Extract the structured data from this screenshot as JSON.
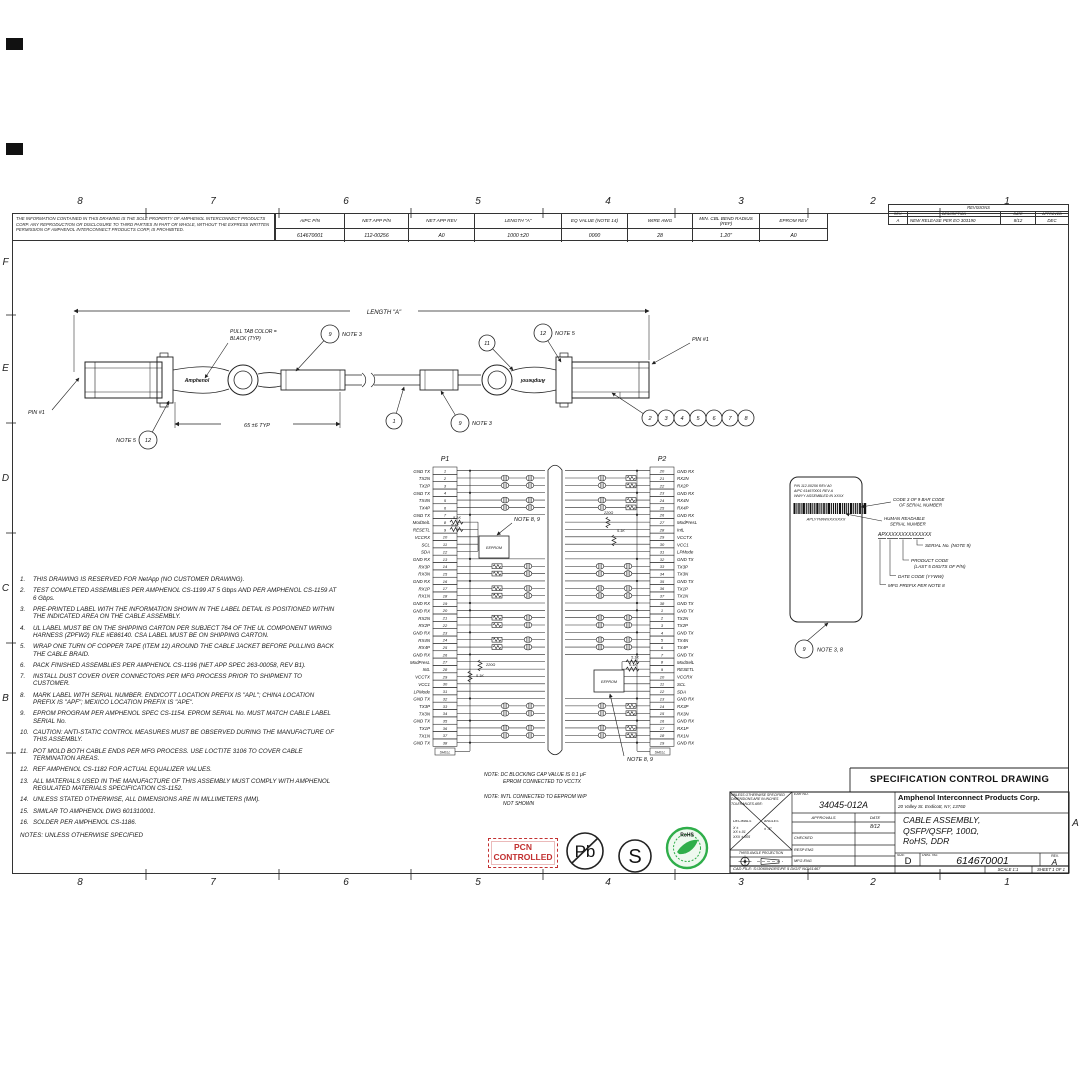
{
  "sheet": {
    "zones_top": [
      "8",
      "7",
      "6",
      "5",
      "4",
      "3",
      "2",
      "1"
    ],
    "zones_bottom": [
      "8",
      "7",
      "6",
      "5",
      "4",
      "3",
      "2",
      "1"
    ],
    "zones_left": [
      "F",
      "E",
      "D",
      "C",
      "B"
    ],
    "zone_right": "A"
  },
  "proprietary_note": "THE INFORMATION CONTAINED IN THIS DRAWING IS THE SOLE PROPERTY OF AMPHENOL INTERCONNECT PRODUCTS CORP.  ANY REPRODUCTION OR DISCLOSURE TO THIRD PARTIES IN PART OR WHOLE, WITHOUT THE EXPRESS WRITTEN PERMISSION OF AMPHENOL INTERCONNECT PRODUCTS CORP, IS PROHIBITED.",
  "parts_table": {
    "headers": [
      "AIPC P/N",
      "NET APP P/N",
      "NET APP REV",
      "LENGTH \"A\"",
      "EQ VALUE (NOTE 14)",
      "WIRE AWG",
      "MIN. CBL BEND RADIUS (REF)",
      "EPROM REV"
    ],
    "values": [
      "614670001",
      "112-00256",
      "A0",
      "1000 ±20",
      "0000",
      "28",
      "1.20\"",
      "A0"
    ]
  },
  "revisions": {
    "title": "REVISIONS",
    "headers": [
      "REV.",
      "DESCRIPTION",
      "DATE",
      "APPROVED"
    ],
    "rows": [
      [
        "A",
        "NEW RELEASE PER EO 303190",
        "8/12",
        "DEC"
      ]
    ]
  },
  "cable": {
    "length_label": "LENGTH \"A\"",
    "pull_tab_label": [
      "PULL TAB COLOR =",
      "BLACK (TYP)"
    ],
    "dim_65": "65 ±6 TYP",
    "pin1_left": "PIN #1",
    "pin1_right": "PIN #1",
    "brand": "Amphenol",
    "balloons": [
      {
        "n": "9",
        "note": "NOTE 3",
        "side": "right",
        "x": 330,
        "y": 334,
        "tx": 296,
        "ty": 371
      },
      {
        "n": "11",
        "x": 487,
        "y": 343,
        "tx": 513,
        "ty": 370
      },
      {
        "n": "12",
        "note": "NOTE 5",
        "side": "right",
        "x": 543,
        "y": 333,
        "tx": 561,
        "ty": 362
      },
      {
        "n": "12",
        "note": "NOTE 5",
        "side": "left",
        "x": 148,
        "y": 440,
        "tx": 169,
        "ty": 401
      },
      {
        "n": "1",
        "x": 394,
        "y": 421,
        "tx": 404,
        "ty": 387
      },
      {
        "n": "9",
        "note": "NOTE 3",
        "side": "right",
        "x": 460,
        "y": 423,
        "tx": 441,
        "ty": 391
      },
      {
        "n": "2",
        "x": 650,
        "y": 418,
        "tx": 612,
        "ty": 393
      },
      {
        "n": "3",
        "x": 666,
        "y": 418
      },
      {
        "n": "4",
        "x": 682,
        "y": 418
      },
      {
        "n": "5",
        "x": 698,
        "y": 418
      },
      {
        "n": "6",
        "x": 714,
        "y": 418
      },
      {
        "n": "7",
        "x": 730,
        "y": 418
      },
      {
        "n": "8",
        "x": 746,
        "y": 418
      }
    ]
  },
  "schematic": {
    "p1_title": "P1",
    "p2_title": "P2",
    "shell_label": "SHELL",
    "eeprom_label": "EEPROM",
    "note_8_9": "NOTE 8, 9",
    "r_5k1": "5.1K",
    "r_220": "220Ω",
    "bottom_notes": [
      [
        "NOTE:  DC BLOCKING CAP VALUE IS 0.1 µF",
        "EPROM CONNECTED TO VCCTX"
      ],
      [
        "NOTE:  INTL CONNECTED TO EEPROM W/P",
        "NOT SHOWN"
      ]
    ],
    "p1_pins": [
      {
        "p": "1",
        "n": "GND TX"
      },
      {
        "p": "2",
        "n": "TX2N"
      },
      {
        "p": "3",
        "n": "TX2P"
      },
      {
        "p": "4",
        "n": "GND TX"
      },
      {
        "p": "5",
        "n": "TX4N"
      },
      {
        "p": "6",
        "n": "TX4P"
      },
      {
        "p": "7",
        "n": "GND TX"
      },
      {
        "p": "8",
        "n": "ModSelL"
      },
      {
        "p": "9",
        "n": "RESETL"
      },
      {
        "p": "10",
        "n": "VCCRX"
      },
      {
        "p": "11",
        "n": "SCL"
      },
      {
        "p": "12",
        "n": "SDA"
      },
      {
        "p": "13",
        "n": "GND RX"
      },
      {
        "p": "14",
        "n": "RX3P"
      },
      {
        "p": "15",
        "n": "RX3N"
      },
      {
        "p": "16",
        "n": "GND RX"
      },
      {
        "p": "17",
        "n": "RX1P"
      },
      {
        "p": "18",
        "n": "RX1N"
      },
      {
        "p": "19",
        "n": "GND RX"
      },
      {
        "p": "20",
        "n": "GND RX"
      },
      {
        "p": "21",
        "n": "RX2N"
      },
      {
        "p": "22",
        "n": "RX2P"
      },
      {
        "p": "23",
        "n": "GND RX"
      },
      {
        "p": "24",
        "n": "RX4N"
      },
      {
        "p": "25",
        "n": "RX4P"
      },
      {
        "p": "26",
        "n": "GND RX"
      },
      {
        "p": "27",
        "n": "ModPresL"
      },
      {
        "p": "28",
        "n": "IntL"
      },
      {
        "p": "29",
        "n": "VCCTX"
      },
      {
        "p": "30",
        "n": "VCC1"
      },
      {
        "p": "31",
        "n": "LPMode"
      },
      {
        "p": "32",
        "n": "GND TX"
      },
      {
        "p": "33",
        "n": "TX3P"
      },
      {
        "p": "34",
        "n": "TX3N"
      },
      {
        "p": "35",
        "n": "GND TX"
      },
      {
        "p": "36",
        "n": "TX1P"
      },
      {
        "p": "37",
        "n": "TX1N"
      },
      {
        "p": "38",
        "n": "GND TX"
      }
    ],
    "p2_pins": [
      {
        "p": "20",
        "n": "GND RX"
      },
      {
        "p": "21",
        "n": "RX2N"
      },
      {
        "p": "22",
        "n": "RX2P"
      },
      {
        "p": "23",
        "n": "GND RX"
      },
      {
        "p": "24",
        "n": "RX4N"
      },
      {
        "p": "25",
        "n": "RX4P"
      },
      {
        "p": "26",
        "n": "GND RX"
      },
      {
        "p": "27",
        "n": "ModPresL"
      },
      {
        "p": "28",
        "n": "IntL"
      },
      {
        "p": "29",
        "n": "VCCTX"
      },
      {
        "p": "30",
        "n": "VCC1"
      },
      {
        "p": "31",
        "n": "LPMode"
      },
      {
        "p": "32",
        "n": "GND TX"
      },
      {
        "p": "33",
        "n": "TX3P"
      },
      {
        "p": "34",
        "n": "TX3N"
      },
      {
        "p": "35",
        "n": "GND TX"
      },
      {
        "p": "36",
        "n": "TX1P"
      },
      {
        "p": "37",
        "n": "TX1N"
      },
      {
        "p": "38",
        "n": "GND TX"
      },
      {
        "p": "1",
        "n": "GND TX"
      },
      {
        "p": "2",
        "n": "TX2N"
      },
      {
        "p": "3",
        "n": "TX2P"
      },
      {
        "p": "4",
        "n": "GND TX"
      },
      {
        "p": "5",
        "n": "TX4N"
      },
      {
        "p": "6",
        "n": "TX4P"
      },
      {
        "p": "7",
        "n": "GND TX"
      },
      {
        "p": "8",
        "n": "ModSelL"
      },
      {
        "p": "9",
        "n": "RESETL"
      },
      {
        "p": "10",
        "n": "VCCRX"
      },
      {
        "p": "11",
        "n": "SCL"
      },
      {
        "p": "12",
        "n": "SDA"
      },
      {
        "p": "13",
        "n": "GND RX"
      },
      {
        "p": "14",
        "n": "RX3P"
      },
      {
        "p": "15",
        "n": "RX3N"
      },
      {
        "p": "16",
        "n": "GND RX"
      },
      {
        "p": "17",
        "n": "RX1P"
      },
      {
        "p": "18",
        "n": "RX1N"
      },
      {
        "p": "19",
        "n": "GND RX"
      }
    ]
  },
  "label_detail": {
    "label_lines": [
      "P/N 112-00256 REV A0",
      "AIPC 614670001 REV A",
      "WWYY ASSEMBLED IN XXXX"
    ],
    "serial_text": "APLYYWWXXXXXXX",
    "barcode_callout": [
      "CODE 3 OF 9 BAR CODE",
      "OF SERIAL NUMBER"
    ],
    "human_callout": [
      "HUMAN READABLE",
      "SERIAL NUMBER"
    ],
    "breakdown_text": "APXXXXXXXXXXXXXX",
    "callouts": [
      [
        "SERIAL No. (NOTE 9)"
      ],
      [
        "PRODUCT CODE",
        "(LAST 5 DIGITS OF P/N)"
      ],
      [
        "DATE CODE (YYWW)"
      ],
      [
        "MFG PREFIX PER NOTE 8"
      ]
    ],
    "balloon": "9",
    "balloon_note": "NOTE 3, 8"
  },
  "notes": {
    "items": [
      "THIS DRAWING IS RESERVED FOR NetApp (NO CUSTOMER DRAWING).",
      "TEST COMPLETED ASSEMBLIES PER AMPHENOL CS-1199 AT 5 Gbps AND PER AMPHENOL CS-1159 AT 6 Gbps.",
      "PRE-PRINTED LABEL WITH THE INFORMATION SHOWN IN THE LABEL DETAIL IS POSITIONED WITHIN THE INDICATED AREA ON THE CABLE ASSEMBLY.",
      "UL LABEL MUST BE ON THE SHIPPING CARTON PER SUBJECT 764 OF THE UL COMPONENT WIRING HARNESS (ZPFW2) FILE #E86140.  CSA LABEL MUST BE ON SHIPPING CARTON.",
      "WRAP ONE TURN OF COPPER TAPE (ITEM 12) AROUND THE CABLE JACKET BEFORE PULLING BACK THE CABLE BRAID.",
      "PACK FINISHED ASSEMBLIES PER AMPHENOL CS-1196 (NET APP SPEC 263-00058, REV B1).",
      "INSTALL DUST COVER OVER CONNECTORS PER MFG PROCESS PRIOR TO SHIPMENT TO CUSTOMER.",
      "MARK LABEL WITH SERIAL NUMBER.  ENDICOTT LOCATION PREFIX IS \"APL\"; CHINA LOCATION PREFIX IS \"APF\"; MEXICO LOCATION PREFIX IS \"APE\".",
      "EPROM PROGRAM PER AMPHENOL SPEC CS-1154.  EPROM SERIAL No. MUST MATCH CABLE LABEL SERIAL No.",
      "CAUTION:  ANTI-STATIC CONTROL MEASURES MUST BE OBSERVED DURING THE MANUFACTURE OF THIS ASSEMBLY.",
      "POT MOLD BOTH CABLE ENDS PER MFG PROCESS.  USE LOCTITE 3106 TO COVER CABLE TERMINATION AREAS.",
      "REF AMPHENOL CS-1182 FOR ACTUAL EQUALIZER VALUES.",
      "ALL MATERIALS USED IN THE MANUFACTURE OF THIS ASSEMBLY MUST COMPLY WITH AMPHENOL REGULATED MATERIALS SPECIFICATION CS-1152.",
      "UNLESS STATED OTHERWISE, ALL DIMENSIONS ARE IN MILLIMETERS (MM).",
      "SIMILAR TO AMPHENOL DWG 601310001.",
      "SOLDER PER AMPHENOL CS-1186."
    ],
    "footer": "NOTES: UNLESS OTHERWISE SPECIFIED"
  },
  "stamps": {
    "pcn": "PCN\nCONTROLLED",
    "pb": "Pb",
    "s": "S",
    "rohs": "RoHS"
  },
  "spec_title": "SPECIFICATION CONTROL DRAWING",
  "title_block": {
    "tol_header": "UNLESS OTHERWISE SPECIFIED DIMENSIONS ARE IN INCHES TOLERANCES ARE:",
    "decimals": "DECIMALS",
    "angles": "ANGLES",
    "angles_val": "± .5°",
    "tol_rows": [
      "X       ±",
      "XX     ±.01",
      "XXX   ±.005"
    ],
    "third_angle": "THIRD ANGLE PROJECTION",
    "ear_label": "EAR NO.",
    "ear": "34045-012A",
    "approvals": "APPROVALS",
    "date_label": "DATE",
    "date": "8/12",
    "row_checked": "CHECKED",
    "row_resp": "RESP ENG",
    "row_mfg": "MFG ENG",
    "company": "Amphenol Interconnect Products Corp.",
    "address": "20 Valley St. Endicott, NY, 13760",
    "title_lines": [
      "CABLE ASSEMBLY,",
      "QSFP/QSFP, 100Ω,",
      "RoHS, DDR"
    ],
    "size_label": "SIZE",
    "size": "D",
    "dwg_label": "DWG.  NO.",
    "dwg_no": "614670001",
    "rev_label": "REV.",
    "rev": "A",
    "scale": "SCALE  1:1",
    "sheet": "SHEET 1 OF 1",
    "cad": "CAD  FILE: S:\\3060WGRS\\PE 5 DIGIT NO\\61467"
  }
}
